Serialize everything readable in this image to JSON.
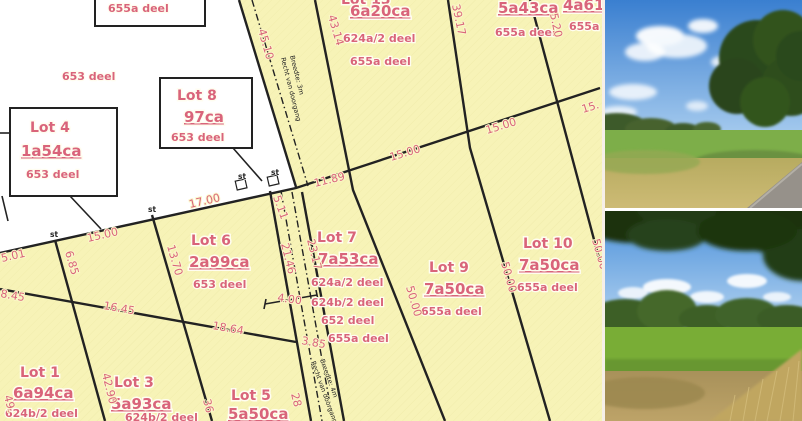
{
  "colors": {
    "parcel_fill": "#f7f3b7",
    "label_pink": "#d9647a",
    "line_black": "#222222"
  },
  "map": {
    "parcels": [
      {
        "id": "lot13",
        "title": "Lot 13",
        "area": "6a20ca",
        "deeds": [
          "624a/2 deel",
          "655a deel"
        ]
      },
      {
        "id": "top5a43",
        "title": "",
        "area": "5a43ca",
        "deeds": [
          "655a deel"
        ]
      },
      {
        "id": "top4a61",
        "title": "",
        "area": "4a61ca",
        "deeds": [
          "655a deel"
        ]
      },
      {
        "id": "lot8",
        "title": "Lot 8",
        "area": "97ca",
        "deeds": [
          "653 deel"
        ]
      },
      {
        "id": "lot4",
        "title": "Lot 4",
        "area": "1a54ca",
        "deeds": [
          "653 deel"
        ]
      },
      {
        "id": "lot6",
        "title": "Lot 6",
        "area": "2a99ca",
        "deeds": [
          "653 deel"
        ]
      },
      {
        "id": "lot7",
        "title": "Lot 7",
        "area": "7a53ca",
        "deeds": [
          "624a/2 deel",
          "624b/2 deel",
          "652 deel",
          "655a deel"
        ]
      },
      {
        "id": "lot9",
        "title": "Lot 9",
        "area": "7a50ca",
        "deeds": [
          "655a deel"
        ]
      },
      {
        "id": "lot10",
        "title": "Lot 10",
        "area": "7a50ca",
        "deeds": [
          "655a deel"
        ]
      },
      {
        "id": "lot1",
        "title": "Lot 1",
        "area": "6a94ca",
        "deeds": [
          "624b/2 deel"
        ]
      },
      {
        "id": "lot3",
        "title": "Lot 3",
        "area": "5a93ca",
        "deeds": [
          "624b/2 deel"
        ]
      },
      {
        "id": "lot5",
        "title": "Lot 5",
        "area": "5a50ca",
        "deeds": []
      }
    ],
    "floating": {
      "deel_653": "653 deel",
      "box_655a": "655a deel"
    },
    "measurements": {
      "m45_10": "45.10",
      "m43_14": "43.14",
      "m39_17": "39.17",
      "m5_20": "5.20",
      "m15a": "15.00",
      "m15cut": "15.",
      "m15b": "15.00",
      "m11_89": "11.89",
      "m5_11": "5.11",
      "m17_00": "17.00",
      "m15c": "15.00",
      "m6_85": "6.85",
      "m5_01": "5.01",
      "m8_45": "8.45",
      "m13_70": "13.70",
      "m16_45": "16.45",
      "m18_64": "18.64",
      "m21_46": "21.46",
      "m23_17": "23.17",
      "m4_00": "4.00",
      "m3_85": "3.85",
      "m50a": "50.00",
      "m50b": "50.00",
      "m50c": "50.00",
      "m42_90": "42.90",
      "m49": "49.",
      "m36": "36",
      "m28": "28"
    },
    "easements": {
      "top": {
        "l1": "Recht van doorgang",
        "l2": "Breedte: 3m"
      },
      "bottom": {
        "l1": "Recht van doorgang",
        "l2": "Breedte: 4m"
      }
    },
    "marker": "st"
  }
}
